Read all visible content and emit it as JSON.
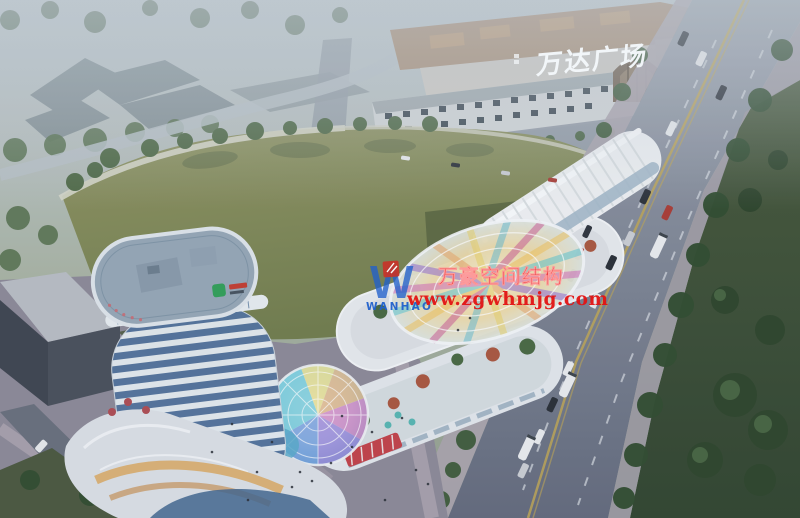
{
  "meta": {
    "title": "Aerial architectural rendering of a mixed-use commercial plaza at dusk",
    "style": "3D visualization, hazy background, dusk lighting"
  },
  "signs": {
    "mall_facade": "万达广场"
  },
  "watermark": {
    "logo_letter": "W",
    "logo_text": "WANHAO",
    "company": "万豪空间结构",
    "website": "www.zgwhmjg.com"
  },
  "palette": {
    "haze_sky": "#bcc5cb",
    "field_green": "#7f8655",
    "lawn_green": "#3a4c32",
    "road_grey": "#6e7682",
    "sidewalk_grey": "#a8a2aa",
    "tower_band_white": "#e4eaee",
    "tower_glass_blue": "#51719a",
    "tower_roof": "#94a5b4",
    "podium_white": "#dadfe4",
    "mall_beige": "#cdc9c2",
    "storefront_glow": "#d9a85f",
    "watermark_red": "#e31414",
    "watermark_blue": "#2161cc",
    "dome_colors": [
      "#ead75a",
      "#e09a4f",
      "#cf56ae",
      "#7e57cf",
      "#4479d4",
      "#3fbcd0"
    ]
  },
  "scene_elements": [
    "hazy industrial blocks",
    "Wanda Plaza mall with rooftop construction",
    "arched mall entrance",
    "retail shopping street",
    "large green field",
    "curved white tower with glass bands",
    "rainbow glass dome",
    "radial rainbow canopy",
    "terraced commercial strips",
    "arterial road with cars and buses",
    "tree-lined lawn",
    "warehouse building"
  ]
}
